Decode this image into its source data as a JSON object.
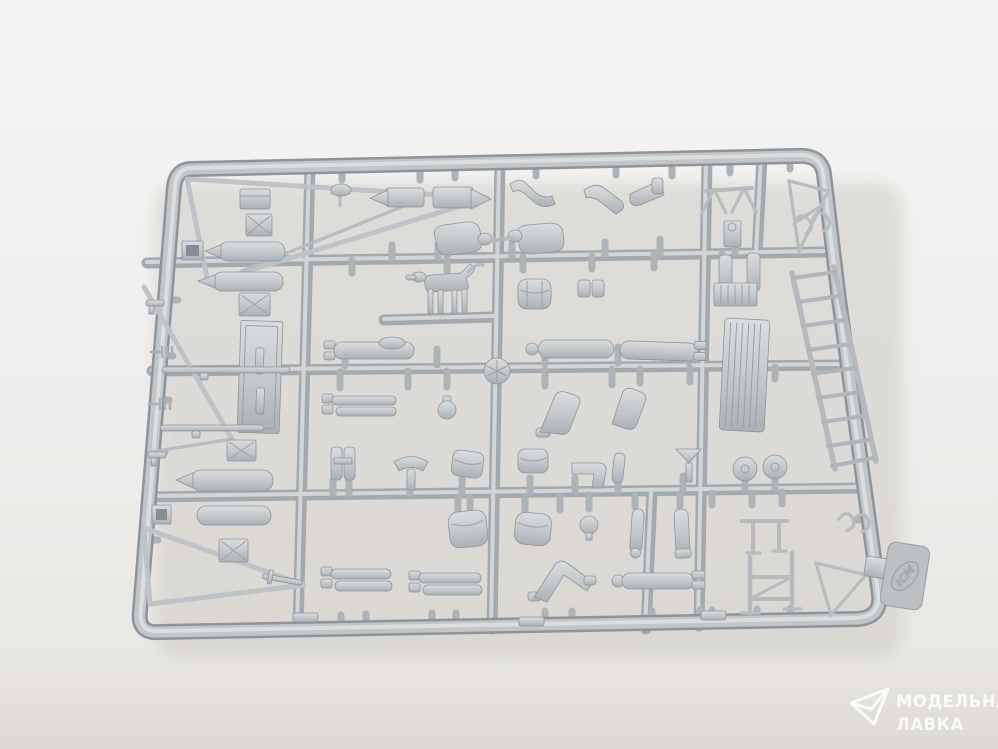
{
  "meta": {
    "type": "product-photograph",
    "subject": "Gray polystyrene model-kit sprue with soldier figures, a dog figure and field accessories, shot on a white studio background"
  },
  "colors": {
    "bg_top": "#f6f5f3",
    "bg_mid": "#efeeec",
    "bg_low": "#e9e7e4",
    "bg_bottom": "#dcd9d5",
    "shadow": "#cfccc7",
    "plastic_hi": "#dadde0",
    "plastic_mid": "#c3c7ca",
    "plastic_lo": "#aab0b5",
    "plastic_edge": "#8e9499",
    "runner": "#a4a9ad",
    "runner_hi": "#d3d6d8",
    "rod": "#bfc3c7",
    "watermark": "#ffffff"
  },
  "sprue": {
    "brand": "ICM",
    "parts": [
      "triangular frame piece",
      "ammo box",
      "jerry can",
      "fuel cylinder",
      "open stowage box",
      "door panel with handles",
      "fork tool",
      "pistol",
      "rifle",
      "dagger",
      "exhaust muffler",
      "bent arm",
      "bent leg",
      "boot",
      "sawhorse stand",
      "winch block",
      "curly bracket",
      "dog figure",
      "soldier torso",
      "backpack",
      "pouch",
      "corrugated bench",
      "corrugated door",
      "lying soldier body",
      "lying soldier legs",
      "fist",
      "kneeling legs",
      "binoculars",
      "saddle",
      "seat",
      "funnel",
      "road wheel",
      "spare head",
      "arm",
      "leg",
      "t-stand",
      "bent knees",
      "stretcher stand",
      "ladder",
      "injection gate disc",
      "brand tab",
      "foot pad"
    ]
  },
  "watermark": {
    "line1": "МОДЕЛЬНАЯ",
    "line2": "ЛАВКА"
  }
}
